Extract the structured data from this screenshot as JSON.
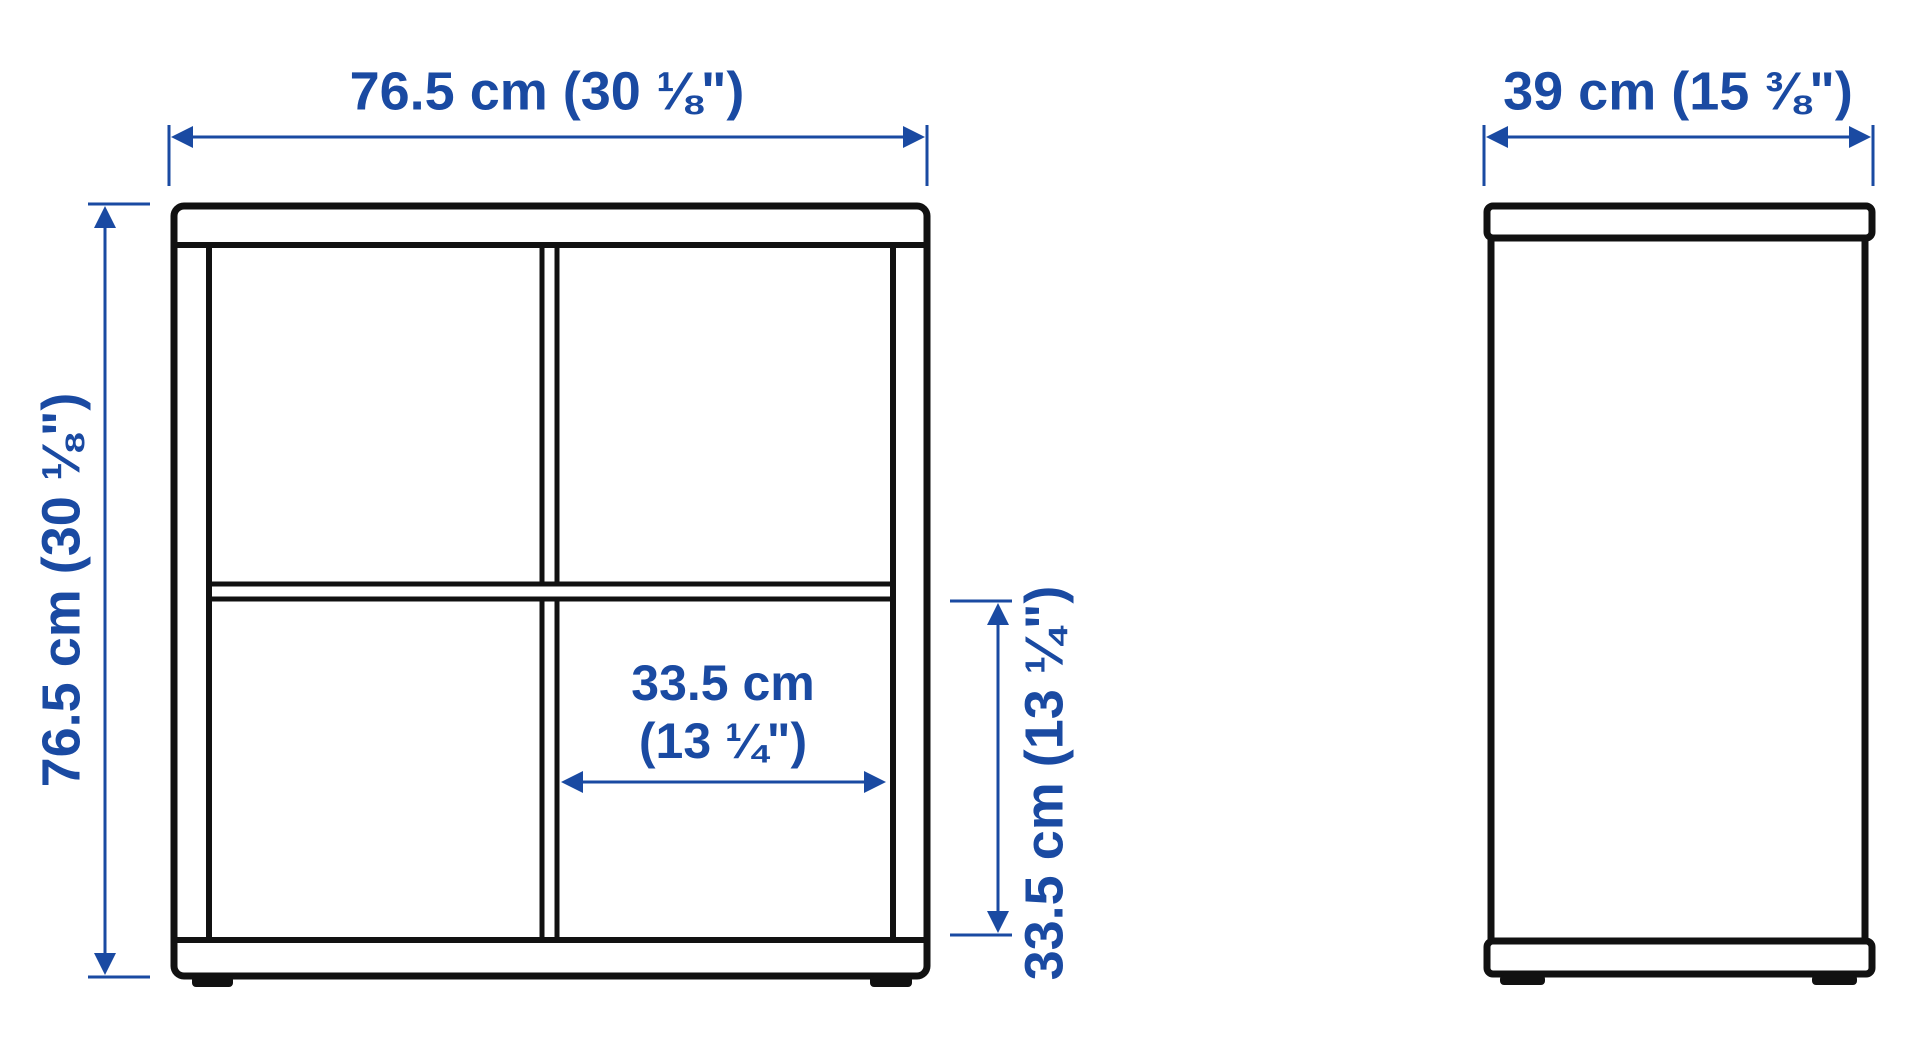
{
  "diagram": {
    "description": "Furniture dimension diagram, front view and side view of a 2x2 cube shelving unit",
    "colors": {
      "dimension_blue": "#1a4aa2",
      "outline_black": "#111111",
      "background": "#ffffff"
    },
    "views": {
      "front": {
        "name": "front view"
      },
      "side": {
        "name": "side view"
      }
    },
    "dimensions": {
      "front_width": {
        "label": "76.5 cm (30 ⅛\")",
        "cm": 76.5,
        "inches": "30 1/8"
      },
      "front_height": {
        "label": "76.5 cm (30 ⅛\")",
        "cm": 76.5,
        "inches": "30 1/8"
      },
      "inner_cell_width": {
        "label_line1": "33.5 cm",
        "label_line2": "(13 ¼\")",
        "cm": 33.5,
        "inches": "13 1/4"
      },
      "inner_cell_height": {
        "label": "33.5 cm (13 ¼\")",
        "cm": 33.5,
        "inches": "13 1/4"
      },
      "side_depth": {
        "label": "39 cm (15 ⅜\")",
        "cm": 39,
        "inches": "15 3/8"
      }
    }
  }
}
